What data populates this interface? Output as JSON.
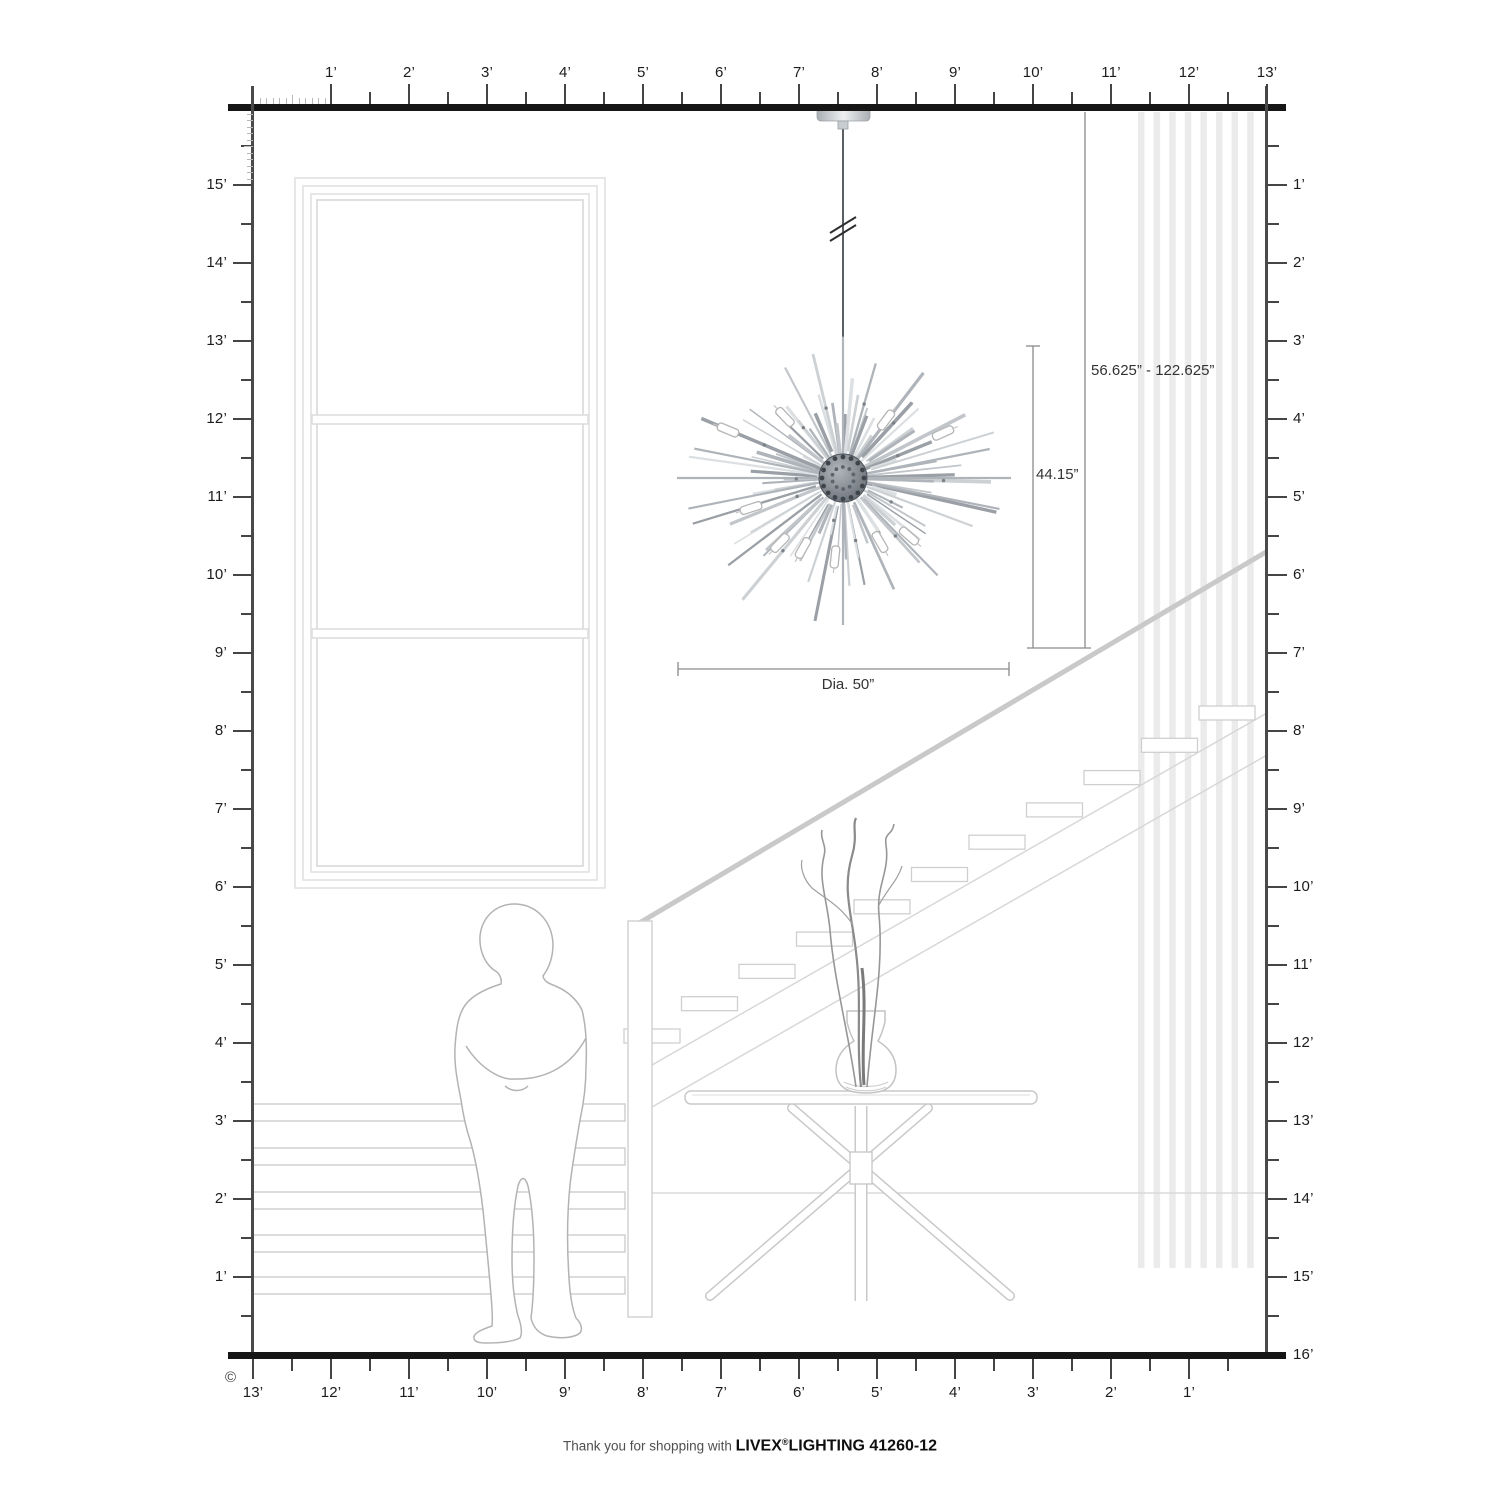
{
  "rulers": {
    "top": {
      "labels": [
        "1’",
        "2’",
        "3’",
        "4’",
        "5’",
        "6’",
        "7’",
        "8’",
        "9’",
        "10’",
        "11’",
        "12’",
        "13’"
      ]
    },
    "bottom": {
      "labels": [
        "13’",
        "12’",
        "11’",
        "10’",
        "9’",
        "8’",
        "7’",
        "6’",
        "5’",
        "4’",
        "3’",
        "2’",
        "1’"
      ]
    },
    "left": {
      "labels": [
        "15’",
        "14’",
        "13’",
        "12’",
        "11’",
        "10’",
        "9’",
        "8’",
        "7’",
        "6’",
        "5’",
        "4’",
        "3’",
        "2’",
        "1’"
      ]
    },
    "right": {
      "labels": [
        "1’",
        "2’",
        "3’",
        "4’",
        "5’",
        "6’",
        "7’",
        "8’",
        "9’",
        "10’",
        "11’",
        "12’",
        "13’",
        "14’",
        "15’",
        "16’"
      ]
    }
  },
  "dimensions": {
    "hang_range": "56.625” - 122.625”",
    "body_height": "44.15”",
    "diameter": "Dia. 50”"
  },
  "copyright_symbol": "©",
  "footer": {
    "prefix": "Thank you for shopping with",
    "brand": "LIVEX",
    "registered": "®",
    "suffix": "LIGHTING 41260-12"
  },
  "chandelier": {
    "center": {
      "x": 843,
      "y": 478
    },
    "rod_count": 84,
    "min_radius": 58,
    "max_radius": 168,
    "vertical_squish": 0.93,
    "rod_palette": [
      "#cdd1d4",
      "#aeb4b9",
      "#c2c6ca",
      "#9aa0a6",
      "#dde0e2"
    ],
    "sphere_color_inner": "#b0b6bc",
    "sphere_color_outer": "#575d65",
    "bulbs": [
      [
        -58,
        -61
      ],
      [
        43,
        -58
      ],
      [
        -115,
        -48
      ],
      [
        100,
        -45
      ],
      [
        -63,
        65
      ],
      [
        -40,
        70
      ],
      [
        37,
        64
      ],
      [
        -8,
        79
      ],
      [
        66,
        58
      ],
      [
        -92,
        30
      ]
    ]
  }
}
